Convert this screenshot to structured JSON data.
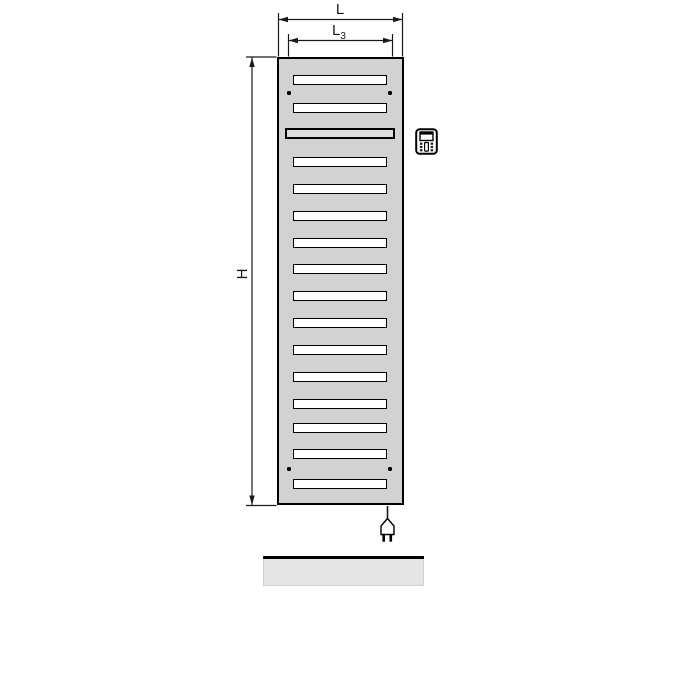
{
  "diagram": {
    "type": "technical-dimension-drawing",
    "subject": "electric-panel-radiator-front-view",
    "labels": {
      "width": "L",
      "element_width": {
        "base": "L",
        "sub": "3"
      },
      "height": "H"
    },
    "colors": {
      "background": "#ffffff",
      "line": "#1a1a1a",
      "radiator_fill": "#d2d2d2",
      "slot_fill": "#ffffff",
      "special_slot_fill": "#dcdcdc",
      "floor_fill": "#e6e6e6"
    },
    "radiator": {
      "x": 277,
      "y": 57,
      "width": 127,
      "height": 448,
      "slot_count": 16,
      "slots": [
        {
          "y": 75
        },
        {
          "y": 103
        },
        {
          "y": 128,
          "special": true
        },
        {
          "y": 157
        },
        {
          "y": 184
        },
        {
          "y": 211
        },
        {
          "y": 238
        },
        {
          "y": 264
        },
        {
          "y": 291
        },
        {
          "y": 318
        },
        {
          "y": 345
        },
        {
          "y": 372
        },
        {
          "y": 399
        },
        {
          "y": 423
        },
        {
          "y": 449
        },
        {
          "y": 479
        }
      ],
      "mount_dots": [
        {
          "x": 289,
          "y": 93
        },
        {
          "x": 390,
          "y": 93
        },
        {
          "x": 289,
          "y": 469
        },
        {
          "x": 390,
          "y": 469
        }
      ]
    },
    "icons": [
      {
        "name": "control-unit-icon",
        "meaning": "electric control/thermostat unit"
      },
      {
        "name": "power-plug-icon",
        "meaning": "mains power cable with plug"
      }
    ]
  }
}
